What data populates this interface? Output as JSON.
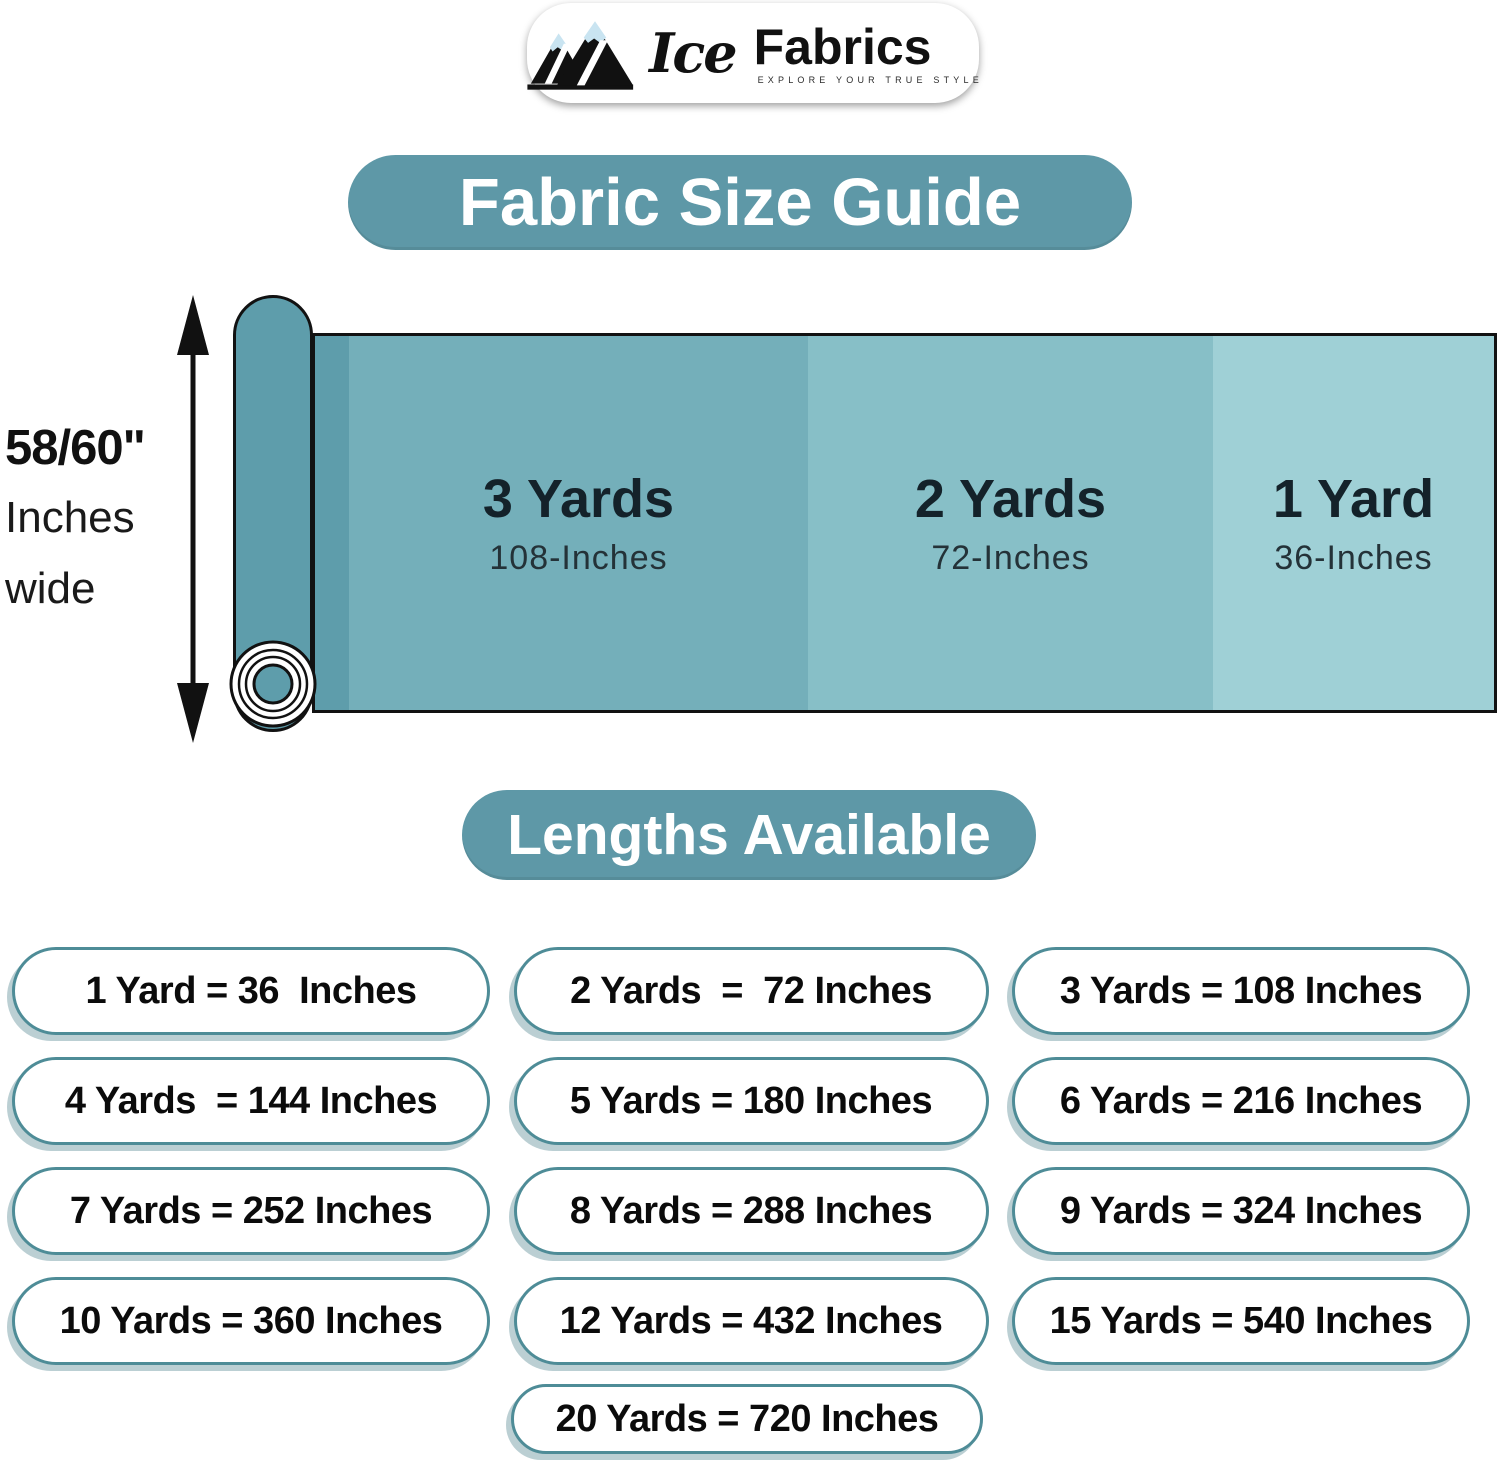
{
  "logo": {
    "brand_ice": "Ice",
    "brand_fabrics": "Fabrics",
    "tagline": "EXPLORE YOUR TRUE STYLE"
  },
  "title": "Fabric Size Guide",
  "diagram": {
    "width_label_line1": "58/60\"",
    "width_label_line2": "Inches",
    "width_label_line3": "wide",
    "roll_color": "#5E9DAB",
    "sections": [
      {
        "yards": "3 Yards",
        "inches": "108-Inches",
        "color": "#74AFBA"
      },
      {
        "yards": "2 Yards",
        "inches": "72-Inches",
        "color": "#87BFC7"
      },
      {
        "yards": "1 Yard",
        "inches": "36-Inches",
        "color": "#9FD0D6"
      }
    ]
  },
  "lengths": {
    "title": "Lengths Available",
    "items": [
      "1 Yard = 36  Inches",
      "2 Yards  =  72 Inches",
      "3 Yards = 108 Inches",
      "4 Yards  = 144 Inches",
      "5 Yards = 180 Inches",
      "6 Yards = 216 Inches",
      "7 Yards = 252 Inches",
      "8 Yards = 288 Inches",
      "9 Yards = 324 Inches",
      "10 Yards = 360 Inches",
      "12 Yards = 432 Inches",
      "15 Yards = 540 Inches",
      "20 Yards = 720 Inches"
    ]
  },
  "colors": {
    "accent": "#5E98A7",
    "pill_border": "#4E8C97",
    "snow": "#C9E4F1"
  }
}
